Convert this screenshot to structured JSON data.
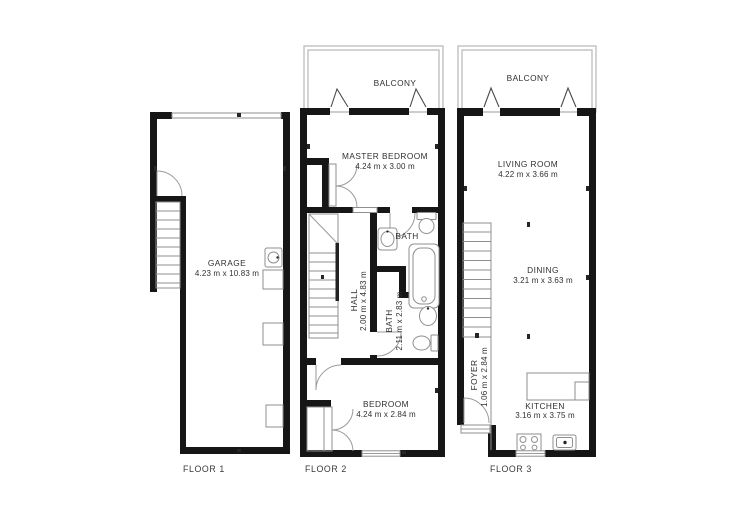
{
  "title": "Floor plans",
  "colors": {
    "wall": "#161616",
    "fixture_line": "#8f8f8f",
    "balcony_rail": "#b6b6b6",
    "text": "#303030",
    "background": "#ffffff"
  },
  "floors": [
    {
      "label": "FLOOR 1",
      "rooms": [
        {
          "name": "GARAGE",
          "dims": "4.23 m x 10.83 m"
        }
      ]
    },
    {
      "label": "FLOOR 2",
      "rooms": [
        {
          "name": "BALCONY",
          "dims": ""
        },
        {
          "name": "MASTER BEDROOM",
          "dims": "4.24 m x 3.00 m"
        },
        {
          "name": "BATH",
          "dims": ""
        },
        {
          "name": "HALL",
          "dims": "2.00 m x 4.83 m"
        },
        {
          "name": "BATH",
          "dims": "2.11 m x 2.83 m"
        },
        {
          "name": "BEDROOM",
          "dims": "4.24 m x 2.84 m"
        }
      ]
    },
    {
      "label": "FLOOR 3",
      "rooms": [
        {
          "name": "BALCONY",
          "dims": ""
        },
        {
          "name": "LIVING ROOM",
          "dims": "4.22 m x 3.66 m"
        },
        {
          "name": "DINING",
          "dims": "3.21 m x 3.63 m"
        },
        {
          "name": "FOYER",
          "dims": "1.06 m x 2.84 m"
        },
        {
          "name": "KITCHEN",
          "dims": "3.16 m x 3.75 m"
        }
      ]
    }
  ]
}
